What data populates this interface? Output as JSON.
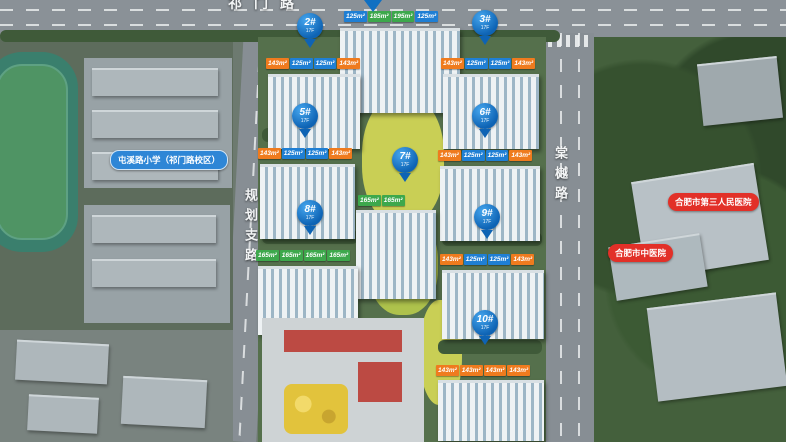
{
  "map": {
    "roads": {
      "top": "祁门路",
      "left": "规划支路",
      "right": "棠樾路"
    },
    "pois": {
      "school": "屯溪路小学（祁门路校区）",
      "hospital_main": "合肥市第三人民医院",
      "hospital_tcm": "合肥市中医院"
    }
  },
  "buildings": [
    {
      "note": "pin cut off at top edge",
      "tags": [
        {
          "text": "125m²",
          "color": "#1f7fd4"
        },
        {
          "text": "185m²",
          "color": "#3da84c"
        },
        {
          "text": "195m²",
          "color": "#3da84c"
        },
        {
          "text": "125m²",
          "color": "#1f7fd4"
        }
      ]
    },
    {
      "id": "2#",
      "floors": "17F",
      "tags": [
        {
          "text": "143m²",
          "color": "#ef7b1e"
        },
        {
          "text": "125m²",
          "color": "#1f7fd4"
        },
        {
          "text": "125m²",
          "color": "#1f7fd4"
        },
        {
          "text": "143m²",
          "color": "#ef7b1e"
        }
      ]
    },
    {
      "id": "3#",
      "floors": "17F",
      "tags": [
        {
          "text": "143m²",
          "color": "#ef7b1e"
        },
        {
          "text": "125m²",
          "color": "#1f7fd4"
        },
        {
          "text": "125m²",
          "color": "#1f7fd4"
        },
        {
          "text": "143m²",
          "color": "#ef7b1e"
        }
      ]
    },
    {
      "id": "5#",
      "floors": "17F",
      "tags": [
        {
          "text": "143m²",
          "color": "#ef7b1e"
        },
        {
          "text": "125m²",
          "color": "#1f7fd4"
        },
        {
          "text": "125m²",
          "color": "#1f7fd4"
        },
        {
          "text": "143m²",
          "color": "#ef7b1e"
        }
      ]
    },
    {
      "id": "6#",
      "floors": "17F",
      "tags": [
        {
          "text": "143m²",
          "color": "#ef7b1e"
        },
        {
          "text": "125m²",
          "color": "#1f7fd4"
        },
        {
          "text": "125m²",
          "color": "#1f7fd4"
        },
        {
          "text": "143m²",
          "color": "#ef7b1e"
        }
      ]
    },
    {
      "id": "7#",
      "floors": "17F",
      "tags": [
        {
          "text": "165m²",
          "color": "#3da84c"
        },
        {
          "text": "165m²",
          "color": "#3da84c"
        }
      ]
    },
    {
      "id": "8#",
      "floors": "17F",
      "tags": [
        {
          "text": "165m²",
          "color": "#3da84c"
        },
        {
          "text": "165m²",
          "color": "#3da84c"
        },
        {
          "text": "165m²",
          "color": "#3da84c"
        },
        {
          "text": "165m²",
          "color": "#3da84c"
        }
      ]
    },
    {
      "id": "9#",
      "floors": "17F",
      "tags": [
        {
          "text": "143m²",
          "color": "#ef7b1e"
        },
        {
          "text": "125m²",
          "color": "#1f7fd4"
        },
        {
          "text": "125m²",
          "color": "#1f7fd4"
        },
        {
          "text": "143m²",
          "color": "#ef7b1e"
        }
      ]
    },
    {
      "id": "10#",
      "floors": "17F",
      "tags": [
        {
          "text": "143m²",
          "color": "#ef7b1e"
        },
        {
          "text": "143m²",
          "color": "#ef7b1e"
        },
        {
          "text": "143m²",
          "color": "#ef7b1e"
        },
        {
          "text": "143m²",
          "color": "#ef7b1e"
        }
      ]
    }
  ],
  "colors": {
    "pin_blue": "#1070c2",
    "tag_blue": "#1f7fd4",
    "tag_orange": "#ef7b1e",
    "tag_green": "#3da84c",
    "poi_red": "#e23028",
    "poi_blue": "#2e86d6"
  }
}
